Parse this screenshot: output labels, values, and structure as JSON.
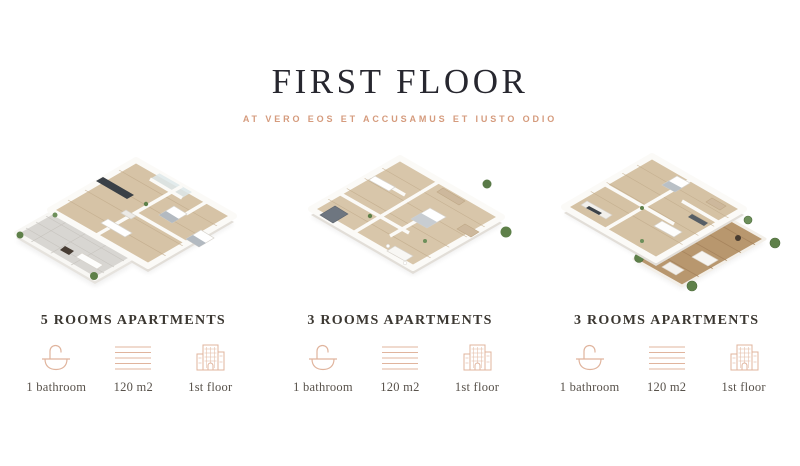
{
  "header": {
    "title": "FIRST FLOOR",
    "subtitle": "AT VERO EOS ET ACCUSAMUS ET IUSTO ODIO"
  },
  "apartments": [
    {
      "title": "5 ROOMS APARTMENTS",
      "features": [
        {
          "icon": "bathtub-icon",
          "label": "1 bathroom"
        },
        {
          "icon": "area-icon",
          "label": "120 m2"
        },
        {
          "icon": "building-icon",
          "label": "1st floor"
        }
      ]
    },
    {
      "title": "3 ROOMS APARTMENTS",
      "features": [
        {
          "icon": "bathtub-icon",
          "label": "1 bathroom"
        },
        {
          "icon": "area-icon",
          "label": "120 m2"
        },
        {
          "icon": "building-icon",
          "label": "1st floor"
        }
      ]
    },
    {
      "title": "3 ROOMS APARTMENTS",
      "features": [
        {
          "icon": "bathtub-icon",
          "label": "1 bathroom"
        },
        {
          "icon": "area-icon",
          "label": "120 m2"
        },
        {
          "icon": "building-icon",
          "label": "1st floor"
        }
      ]
    }
  ],
  "colors": {
    "title": "#27272f",
    "subtitle_accent": "#d59b7d",
    "caption": "#3b3731",
    "label": "#58524b",
    "icon_stroke": "#e0b49d",
    "floor_wood": "#d6c3a6",
    "deck_wood": "#b8976e",
    "wall_white": "#fbfaf7",
    "plant_green": "#5e8049"
  }
}
